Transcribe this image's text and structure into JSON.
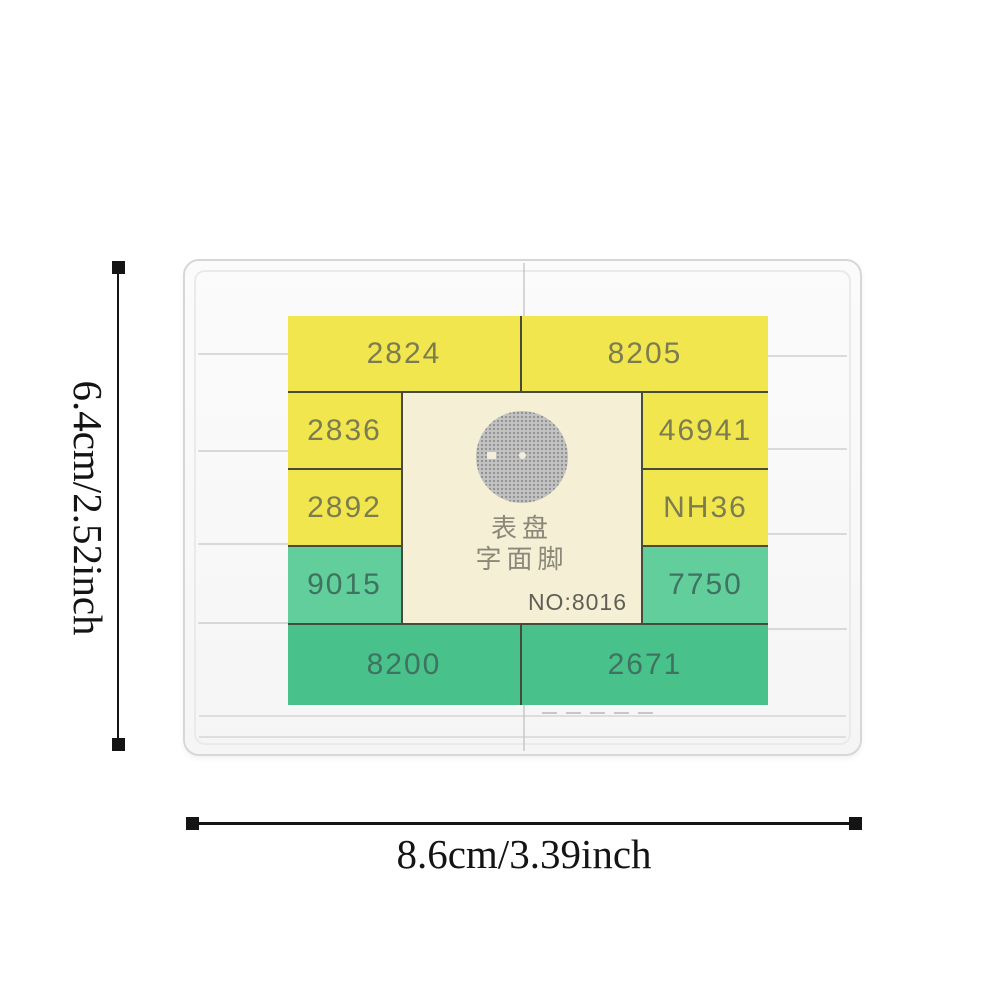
{
  "annotations": {
    "height_label": "6.4cm/2.52inch",
    "width_label": "8.6cm/3.39inch"
  },
  "label": {
    "cells": [
      {
        "text": "2824",
        "tone": "yellow"
      },
      {
        "text": "8205",
        "tone": "yellow"
      },
      {
        "text": "2836",
        "tone": "yellow"
      },
      {
        "text": "46941",
        "tone": "yellow"
      },
      {
        "text": "2892",
        "tone": "yellow"
      },
      {
        "text": "NH36",
        "tone": "yellow"
      },
      {
        "text": "9015",
        "tone": "green"
      },
      {
        "text": "7750",
        "tone": "green"
      },
      {
        "text": "8200",
        "tone": "green"
      },
      {
        "text": "2671",
        "tone": "green"
      }
    ],
    "center": {
      "title_line1": "表盘",
      "title_line2": "字面脚",
      "model_no": "NO:8016"
    }
  },
  "colors": {
    "yellow": "#f2e64f",
    "green": "#49c18b",
    "green_light": "#61ce9b",
    "panel": "#f4efd5",
    "grid": "#474a3c",
    "yellow_text": "#7b7d50",
    "green_text": "#3f7260",
    "cjk_text": "#8b887a",
    "no_text": "#615f55",
    "dim": "#141414"
  }
}
